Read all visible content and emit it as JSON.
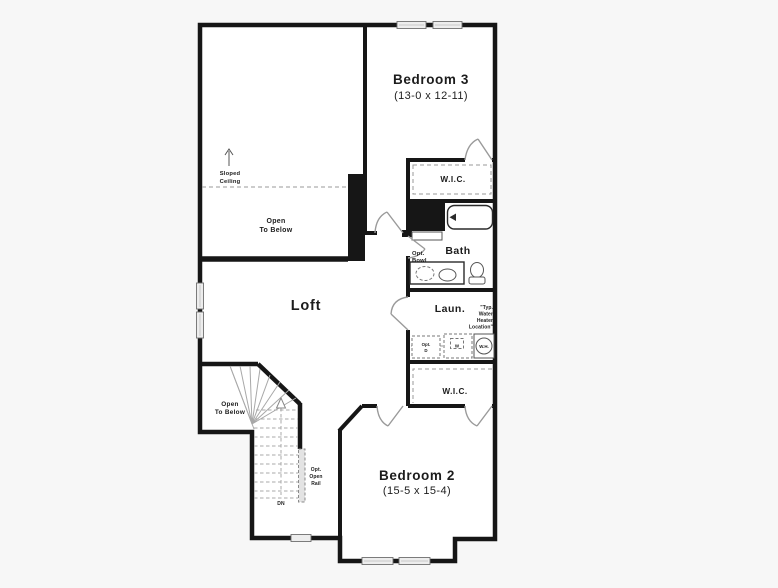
{
  "colors": {
    "background": "#f7f7f7",
    "floor": "#ffffff",
    "wall": "#161616",
    "window_fill": "#ededed",
    "window_stroke": "#6e6e6e",
    "door": "#9a9a9a",
    "tread": "#a8a8a8",
    "dashed": "#9a9a9a",
    "text": "#1c1c1c"
  },
  "plan": {
    "rooms": {
      "bedroom3": {
        "name": "Bedroom 3",
        "dims": "(13-0 x 12-11)"
      },
      "bedroom2": {
        "name": "Bedroom 2",
        "dims": "(15-5 x 15-4)"
      },
      "loft": {
        "name": "Loft"
      },
      "bath": {
        "name": "Bath"
      },
      "laundry": {
        "name": "Laun."
      },
      "wic_upper": {
        "name": "W.I.C."
      },
      "wic_lower": {
        "name": "W.I.C."
      }
    },
    "annotations": {
      "sloped_ceiling": [
        "Sloped",
        "Ceiling"
      ],
      "open_to_below_upper": [
        "Open",
        "To Below"
      ],
      "open_to_below_lower": [
        "Open",
        "To Below"
      ],
      "opt_open_rail": [
        "Opt.",
        "Open",
        "Rail"
      ],
      "down_label": "DN",
      "opt_bowl": [
        "Opt.",
        "Bowl"
      ],
      "water_heater_note": [
        "\"Typ.",
        "Water",
        "Heater",
        "Location\""
      ],
      "opt_dryer": [
        "Opt.",
        "D"
      ],
      "washer_label": "W",
      "water_heater_label": "W.H."
    }
  }
}
